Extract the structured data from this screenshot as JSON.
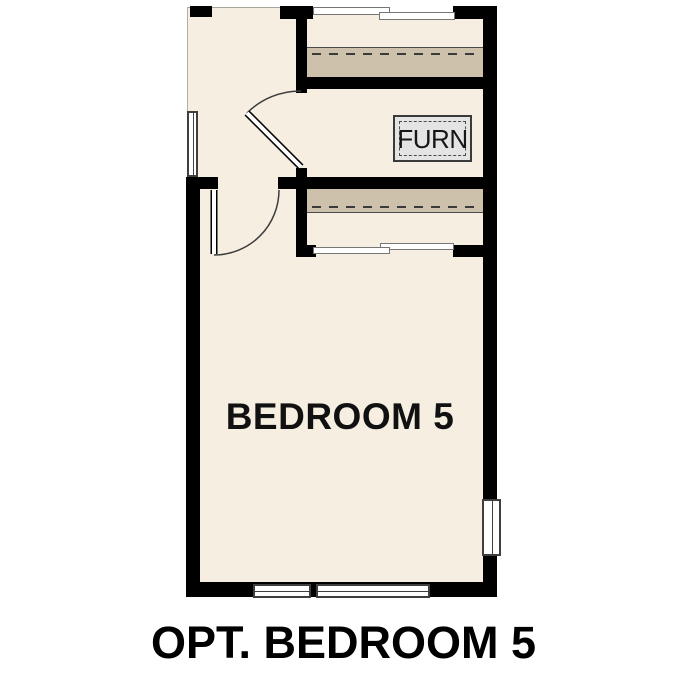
{
  "plan": {
    "room_label": "BEDROOM 5",
    "furnace_label": "FURN",
    "caption": "OPT. BEDROOM 5"
  },
  "colors": {
    "background": "#ffffff",
    "interior": "#f5eee1",
    "shelf": "#cdc1ab",
    "wall": "#000000",
    "furnace_fill": "#e4e4e4",
    "label_text": "#111111"
  }
}
